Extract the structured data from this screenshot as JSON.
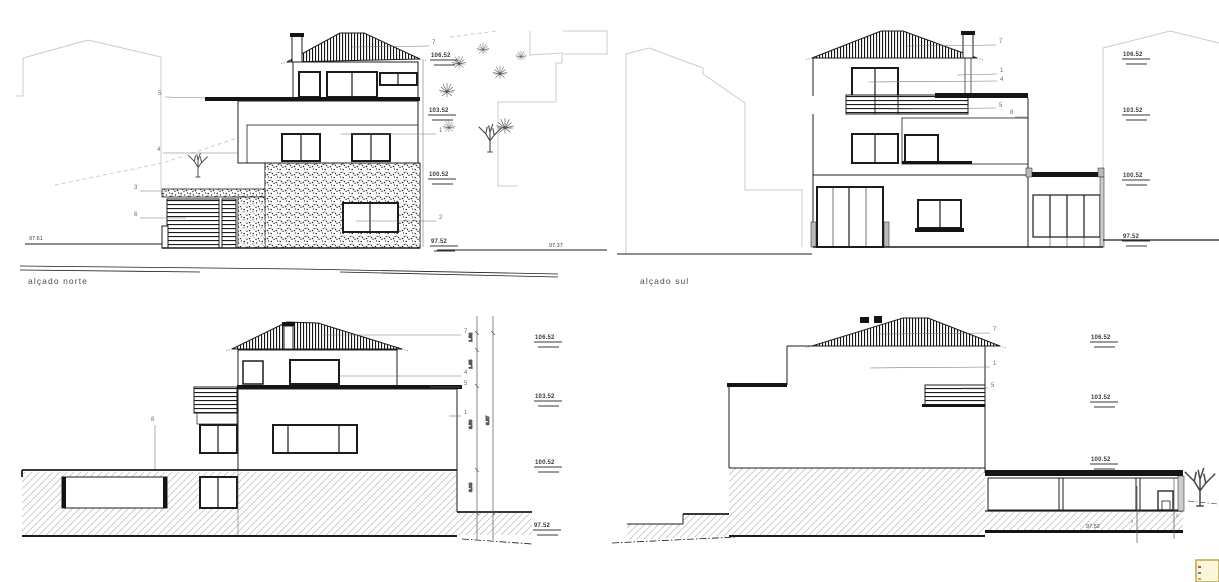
{
  "meta": {
    "ink_color": "#1c1c1c",
    "neighbor_color": "#cccccc",
    "callout_color": "#5f6b85",
    "level_color": "#3a3a3a",
    "stamp_border_color": "#b9a845",
    "stamp_fill_color": "#fcf7dc"
  },
  "north": {
    "title": "alçado norte",
    "levels": {
      "l1": "106.52",
      "l2": "103.52",
      "l3": "100.52",
      "l4": "97.52"
    },
    "spots": {
      "left": "97.61",
      "right": "97.37"
    },
    "callouts": {
      "c7": "7",
      "c5": "5",
      "c4": "4",
      "c3": "3",
      "c6": "6",
      "c1": "1",
      "c2": "2"
    }
  },
  "south": {
    "title": "alçado sul",
    "levels": {
      "l1": "106.52",
      "l2": "103.52",
      "l3": "100.52",
      "l4": "97.52"
    },
    "callouts": {
      "c7": "7",
      "c1": "1",
      "c4": "4",
      "c5": "5",
      "c8": "8"
    }
  },
  "lower_left": {
    "levels": {
      "l1": "106.52",
      "l2": "103.52",
      "l3": "100.52",
      "l4": "97.52"
    },
    "callouts": {
      "c7": "7",
      "c4": "4",
      "c5": "5",
      "c1": "1",
      "c8": "8"
    },
    "dims": {
      "d1": "1.52",
      "d2": "1.65",
      "d3": "3.50",
      "d4": "3.00",
      "total": "9.67"
    }
  },
  "lower_right": {
    "levels": {
      "l1": "106.52",
      "l2": "103.52",
      "l3": "100.52"
    },
    "ground": "97.52",
    "callouts": {
      "c7": "7",
      "c1": "1",
      "c5": "5",
      "c4": "4",
      "c2": "2"
    }
  }
}
